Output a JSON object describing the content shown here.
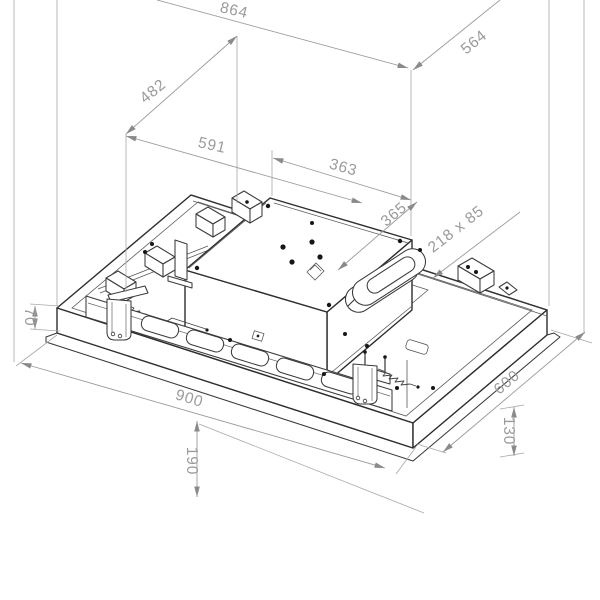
{
  "drawing": {
    "type": "isometric dimensioned technical drawing",
    "subject": "ceiling-mounted extractor hood unit with motor box, duct outlet, vent rail and mounting brackets",
    "background": "#ffffff",
    "colors": {
      "object_line": "#2e2e2e",
      "dimension_line": "#9b9b9b",
      "dimension_text": "#9b9b9b"
    },
    "dimensions": [
      {
        "name": "overall-top-width",
        "label": "864"
      },
      {
        "name": "overall-top-depth",
        "label": "564"
      },
      {
        "name": "motor-box-offset-depth",
        "label": "482"
      },
      {
        "name": "motor-box-offset-width",
        "label": "591"
      },
      {
        "name": "motor-box-width",
        "label": "363"
      },
      {
        "name": "motor-box-depth",
        "label": "365"
      },
      {
        "name": "duct-outlet-size",
        "label": "218 x 85"
      },
      {
        "name": "frame-height",
        "label": "70"
      },
      {
        "name": "panel-width",
        "label": "900"
      },
      {
        "name": "suspension-drop",
        "label": "190"
      },
      {
        "name": "panel-depth",
        "label": "600"
      },
      {
        "name": "side-recess-height",
        "label": "130"
      }
    ]
  }
}
